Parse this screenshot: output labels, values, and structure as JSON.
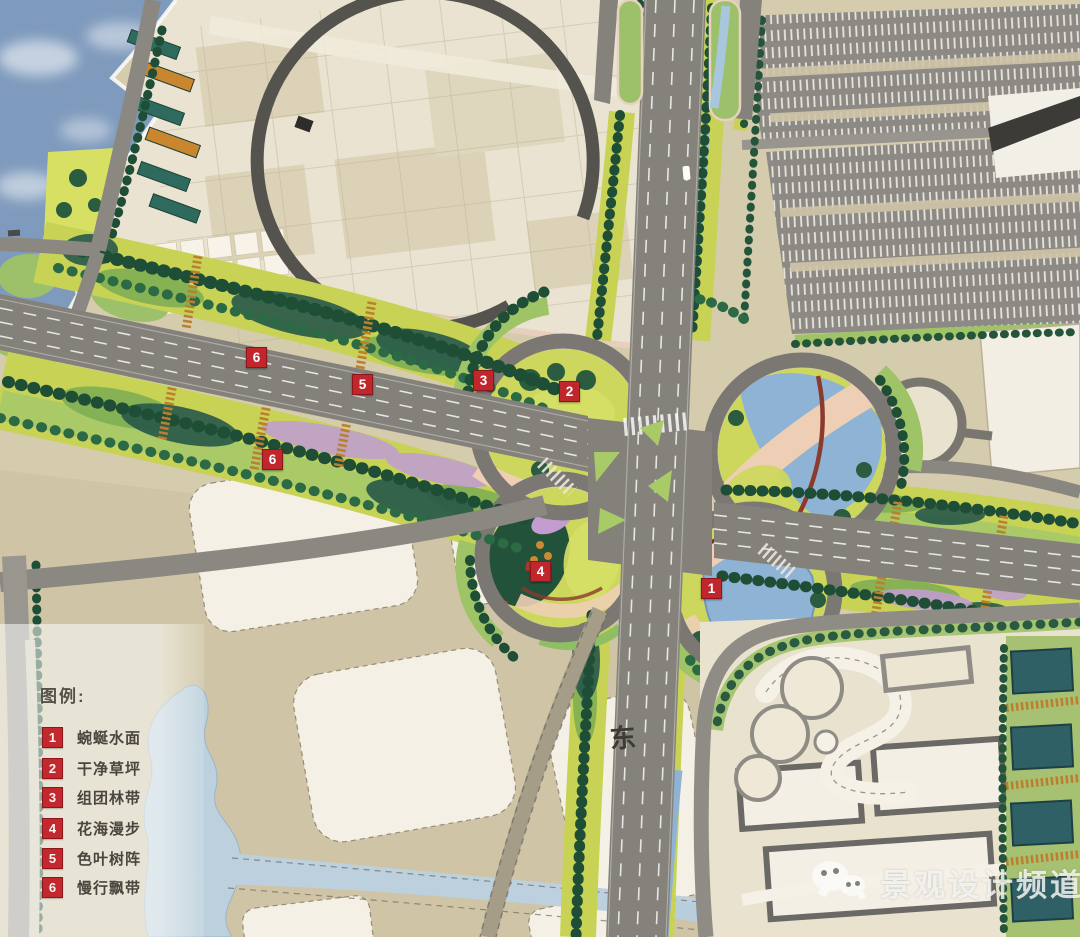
{
  "legend": {
    "title": "图例:",
    "items": [
      {
        "num": "1",
        "label": "蜿蜒水面"
      },
      {
        "num": "2",
        "label": "干净草坪"
      },
      {
        "num": "3",
        "label": "组团林带"
      },
      {
        "num": "4",
        "label": "花海漫步"
      },
      {
        "num": "5",
        "label": "色叶树阵"
      },
      {
        "num": "6",
        "label": "慢行飘带"
      }
    ]
  },
  "markers": [
    {
      "num": "6"
    },
    {
      "num": "5"
    },
    {
      "num": "3"
    },
    {
      "num": "2"
    },
    {
      "num": "6"
    },
    {
      "num": "4"
    },
    {
      "num": "1"
    }
  ],
  "compass": {
    "east": "东"
  },
  "watermark": {
    "text": "景观设计频道",
    "icon": "wechat-icon"
  },
  "colors": {
    "marker_red": "#c0272d",
    "road_gray": "#84817b",
    "lawn_green": "#c8d355",
    "tree_green": "#1e4e36",
    "pond_blue": "#8fb3d4",
    "lake_blue": "#bcd0dd",
    "path_pink": "#eecfb5",
    "flower_purple": "#c09ed0",
    "autumn_orange": "#bb7f2e",
    "plaza_cream": "#eae3d1",
    "land_tan": "#d5cbad",
    "sky_blue": "#7e9abc",
    "watermark_white": "#f9f9f7"
  }
}
